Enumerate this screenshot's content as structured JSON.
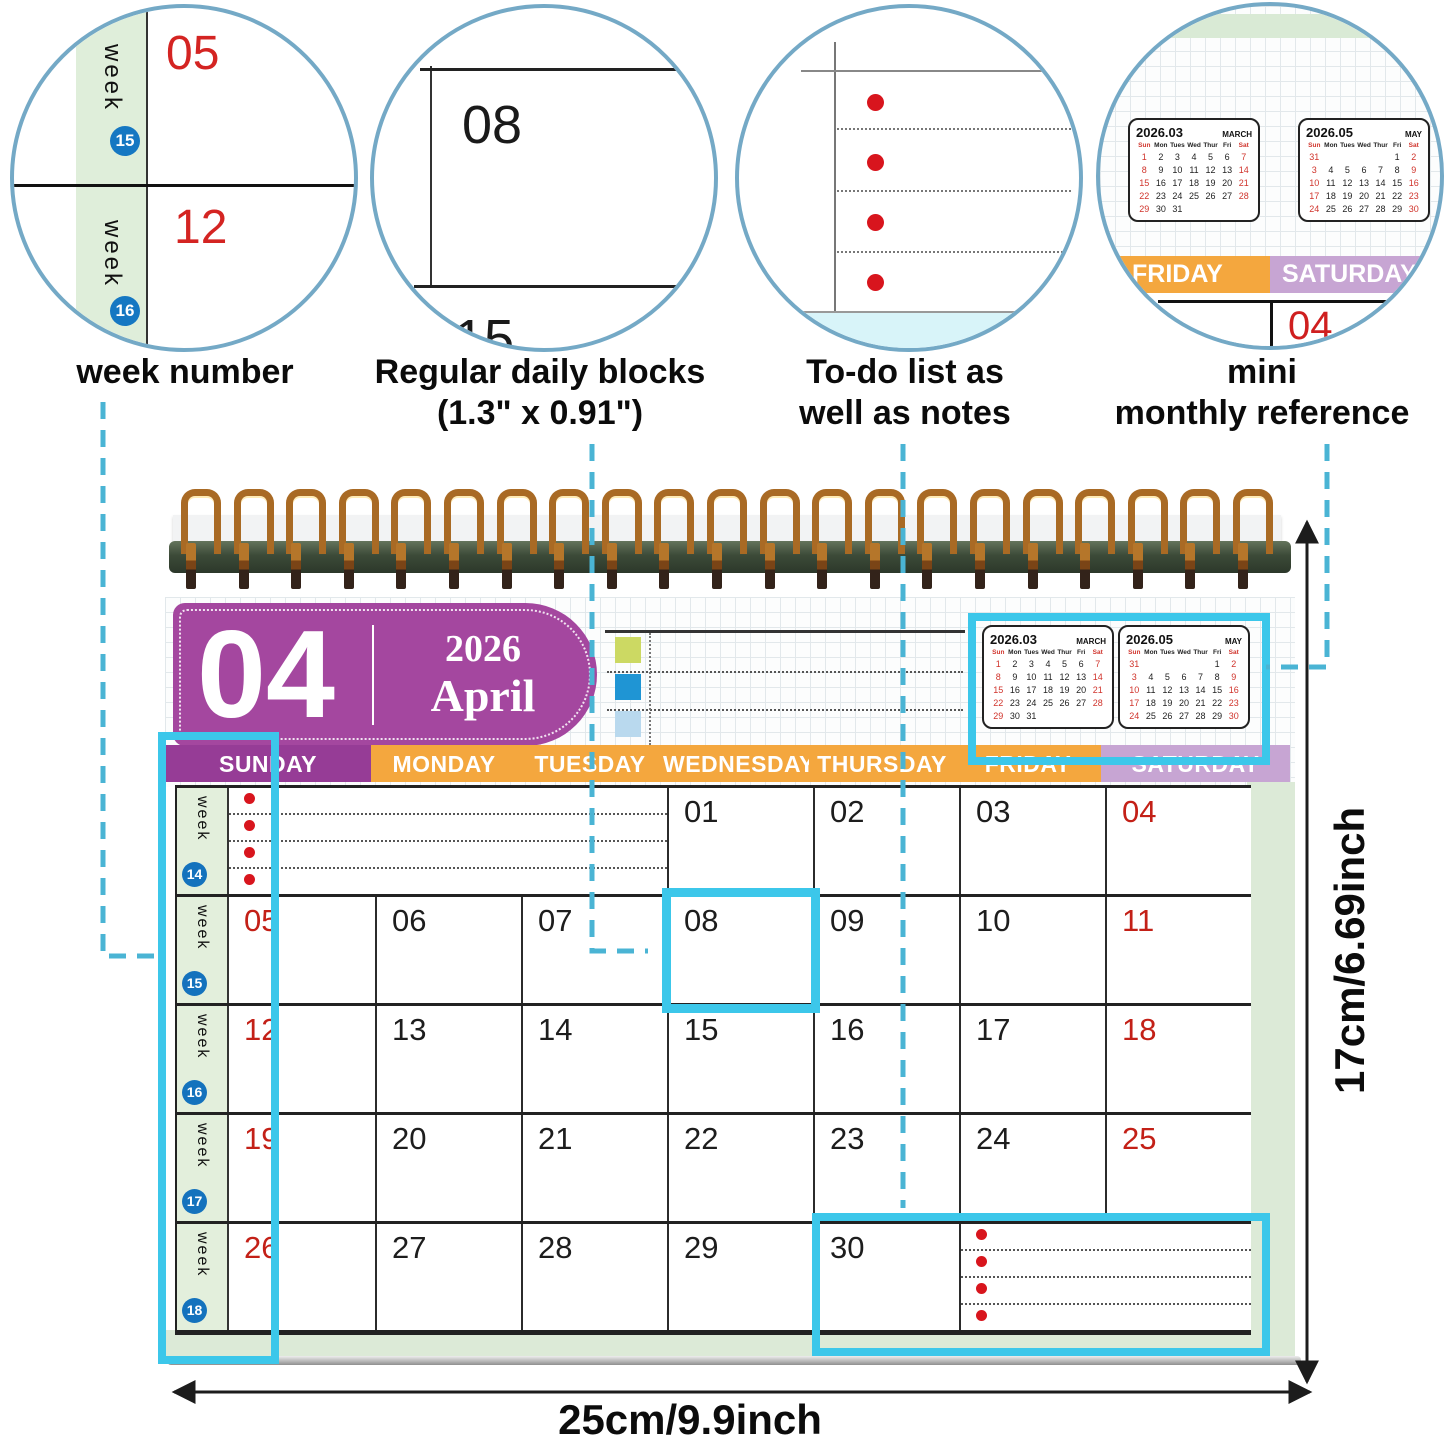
{
  "callouts": {
    "week_number": {
      "label": "week number",
      "week_label": "week",
      "badges": [
        "15",
        "16"
      ],
      "dates": [
        "05",
        "12"
      ]
    },
    "daily_blocks": {
      "label_line1": "Regular daily blocks",
      "label_line2": "(1.3\" x 0.91\")",
      "dates": [
        "08",
        "15"
      ]
    },
    "todo": {
      "label_line1": "To-do list as",
      "label_line2": "well as notes"
    },
    "mini_reference": {
      "label_line1": "mini",
      "label_line2": "monthly reference",
      "friday": "FRIDAY",
      "saturday": "SATURDAY",
      "date": "04"
    }
  },
  "calendar": {
    "month_number": "04",
    "year": "2026",
    "month_name": "April",
    "week_label": "week",
    "day_headers": [
      "SUNDAY",
      "MONDAY",
      "TUESDAY",
      "WEDNESDAY",
      "THURSDAY",
      "FRIDAY",
      "SATURDAY"
    ],
    "weeks": [
      {
        "number": "14",
        "cells": [
          {
            "type": "todo",
            "span": 3
          },
          {
            "type": "date",
            "value": "01"
          },
          {
            "type": "date",
            "value": "02"
          },
          {
            "type": "date",
            "value": "03"
          },
          {
            "type": "date",
            "value": "04",
            "red": true
          }
        ]
      },
      {
        "number": "15",
        "cells": [
          {
            "type": "date",
            "value": "05",
            "red": true
          },
          {
            "type": "date",
            "value": "06"
          },
          {
            "type": "date",
            "value": "07"
          },
          {
            "type": "date",
            "value": "08",
            "highlighted": true
          },
          {
            "type": "date",
            "value": "09"
          },
          {
            "type": "date",
            "value": "10"
          },
          {
            "type": "date",
            "value": "11",
            "red": true
          }
        ]
      },
      {
        "number": "16",
        "cells": [
          {
            "type": "date",
            "value": "12",
            "red": true
          },
          {
            "type": "date",
            "value": "13"
          },
          {
            "type": "date",
            "value": "14"
          },
          {
            "type": "date",
            "value": "15"
          },
          {
            "type": "date",
            "value": "16"
          },
          {
            "type": "date",
            "value": "17"
          },
          {
            "type": "date",
            "value": "18",
            "red": true
          }
        ]
      },
      {
        "number": "17",
        "cells": [
          {
            "type": "date",
            "value": "19",
            "red": true
          },
          {
            "type": "date",
            "value": "20"
          },
          {
            "type": "date",
            "value": "21"
          },
          {
            "type": "date",
            "value": "22"
          },
          {
            "type": "date",
            "value": "23"
          },
          {
            "type": "date",
            "value": "24"
          },
          {
            "type": "date",
            "value": "25",
            "red": true
          }
        ]
      },
      {
        "number": "18",
        "cells": [
          {
            "type": "date",
            "value": "26",
            "red": true
          },
          {
            "type": "date",
            "value": "27"
          },
          {
            "type": "date",
            "value": "28"
          },
          {
            "type": "date",
            "value": "29"
          },
          {
            "type": "date",
            "value": "30"
          },
          {
            "type": "todo",
            "span": 2
          }
        ]
      }
    ],
    "mini_calendars": {
      "weekday_labels": [
        "Sun",
        "Mon",
        "Tues",
        "Wed",
        "Thur",
        "Fri",
        "Sat"
      ],
      "march": {
        "title": "2026.03",
        "name": "MARCH",
        "rows": [
          [
            "1",
            "2",
            "3",
            "4",
            "5",
            "6",
            "7"
          ],
          [
            "8",
            "9",
            "10",
            "11",
            "12",
            "13",
            "14"
          ],
          [
            "15",
            "16",
            "17",
            "18",
            "19",
            "20",
            "21"
          ],
          [
            "22",
            "23",
            "24",
            "25",
            "26",
            "27",
            "28"
          ],
          [
            "29",
            "30",
            "31",
            "",
            "",
            "",
            ""
          ]
        ]
      },
      "may": {
        "title": "2026.05",
        "name": "MAY",
        "rows": [
          [
            "31",
            "",
            "",
            "",
            "",
            "1",
            "2"
          ],
          [
            "3",
            "4",
            "5",
            "6",
            "7",
            "8",
            "9"
          ],
          [
            "10",
            "11",
            "12",
            "13",
            "14",
            "15",
            "16"
          ],
          [
            "17",
            "18",
            "19",
            "20",
            "21",
            "22",
            "23"
          ],
          [
            "24",
            "25",
            "26",
            "27",
            "28",
            "29",
            "30"
          ]
        ]
      }
    }
  },
  "dimensions": {
    "height": "17cm/6.69inch",
    "width": "25cm/9.9inch"
  },
  "colors": {
    "sunday_header": "#963c96",
    "weekday_header": "#f4a73e",
    "saturday_header": "#c7a5d3",
    "month_pill": "#a4479f",
    "week_column_green": "#e3efdc",
    "page_margin_green": "#dcead7",
    "highlight_cyan": "#3cc7ea",
    "connector_teal": "#4ab4d4",
    "red_date": "#c32017",
    "bullet_red": "#d8151d",
    "week_badge_blue": "#1472bd"
  }
}
